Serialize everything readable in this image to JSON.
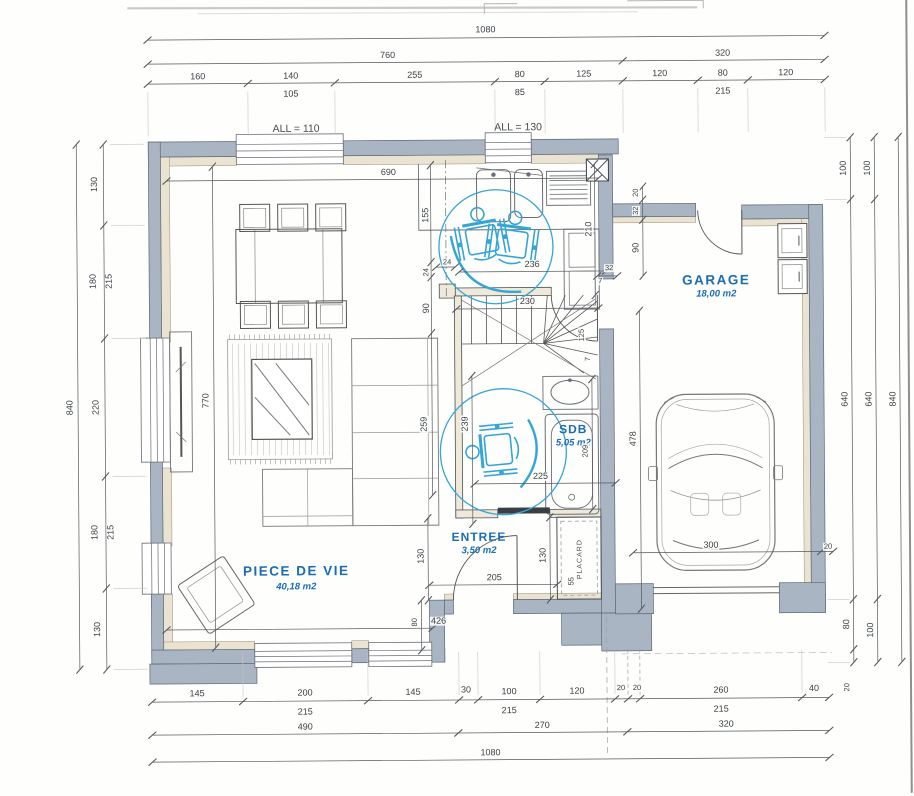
{
  "rooms": {
    "piece_de_vie": {
      "name": "PIECE DE VIE",
      "area": "40,18 m2"
    },
    "entree": {
      "name": "ENTREE",
      "area": "3,50 m2"
    },
    "sdb": {
      "name": "SDB",
      "area": "5,05 m2"
    },
    "garage": {
      "name": "GARAGE",
      "area": "18,00 m2"
    },
    "placard": {
      "name": "PLACARD"
    }
  },
  "window_sills": {
    "all110": "ALL = 110",
    "all130": "ALL = 130"
  },
  "dimensions": {
    "top": {
      "overall": "1080",
      "row2": [
        "760",
        "320"
      ],
      "segments": [
        "160",
        "140",
        "255",
        "80",
        "125",
        "120",
        "80",
        "120"
      ],
      "sub": [
        "105",
        "85",
        "215"
      ]
    },
    "bottom": {
      "segments": [
        "145",
        "200",
        "145",
        "30",
        "100",
        "120",
        "20",
        "20",
        "260",
        "40"
      ],
      "sub": [
        "215",
        "215",
        "215"
      ],
      "row2": [
        "490",
        "270",
        "320"
      ],
      "overall": "1080"
    },
    "left": {
      "segments": [
        "130",
        "180",
        "220",
        "180",
        "130"
      ],
      "sub": [
        "215",
        "215"
      ],
      "overall": "840"
    },
    "right": {
      "chain1": [
        "100",
        "640",
        "80",
        "20"
      ],
      "chain2": [
        "100",
        "640",
        "100"
      ],
      "overall": "840"
    },
    "interior": {
      "kw690": "690",
      "v155": "155",
      "v24": "24",
      "v90": "90",
      "v259": "259",
      "post24": "24",
      "hall236": "236",
      "door32": "32",
      "s7a": "7",
      "s7b": "7",
      "stair230": "230",
      "stair125": "125",
      "col210": "210",
      "g20": "20",
      "g32": "32",
      "g90": "90",
      "sdb239": "239",
      "sdb225": "225",
      "sdb209": "209",
      "sdb478": "478",
      "e205": "205",
      "e130a": "130",
      "e130b": "130",
      "e80": "80",
      "p55": "55",
      "lv426": "426",
      "lv770": "770",
      "gar300": "300",
      "gar20": "20"
    }
  }
}
